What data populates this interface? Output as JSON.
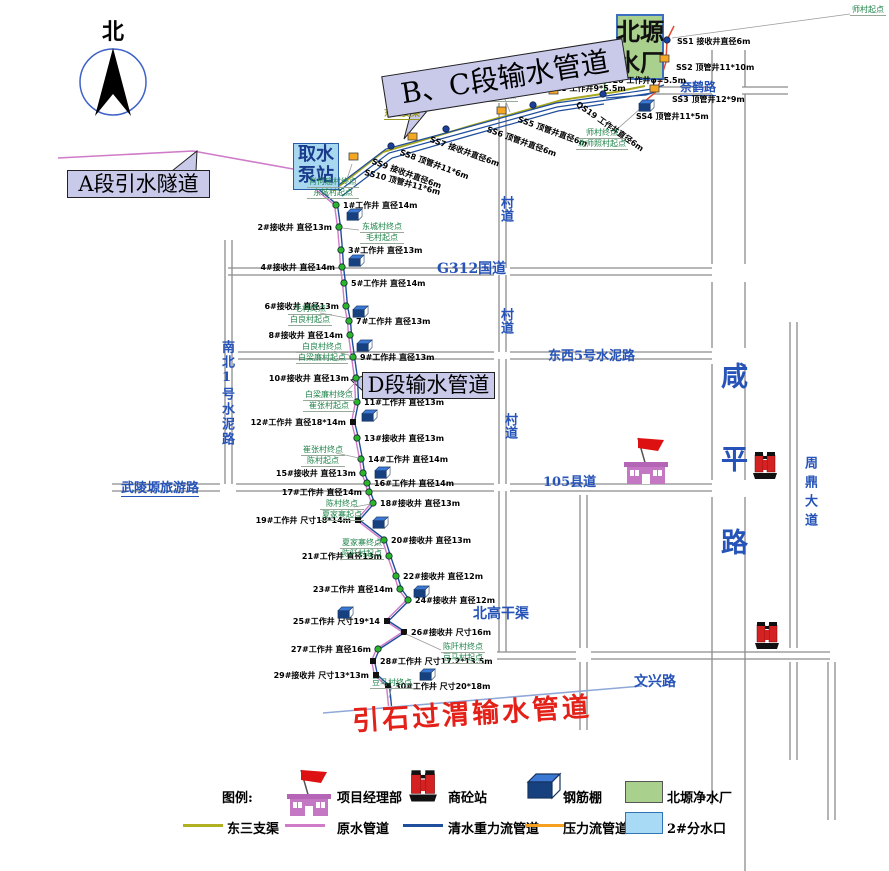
{
  "map": {
    "north_label": "北",
    "section_labels": {
      "bc": "B、C段输水管道",
      "a": "A段引水隧道",
      "d": "D段输水管道"
    },
    "intake_lines": [
      "取水",
      "泵站"
    ],
    "plant_lines": [
      "北塬",
      "净水厂"
    ],
    "yinshi_pipeline": "引石过渭输水管道",
    "dongsan_canal": "东三支渠",
    "road_labels": [
      {
        "text": "G312国道",
        "x": 437,
        "y": 258,
        "size": 14
      },
      {
        "text": "村道",
        "x": 496,
        "y": 196,
        "size": 13,
        "vertical": true
      },
      {
        "text": "村道",
        "x": 496,
        "y": 308,
        "size": 13,
        "vertical": true
      },
      {
        "text": "村道",
        "x": 500,
        "y": 413,
        "size": 13,
        "vertical": true
      },
      {
        "text": "东西5号水泥路",
        "x": 548,
        "y": 345,
        "size": 13
      },
      {
        "text": "105县道",
        "x": 543,
        "y": 471,
        "size": 13
      },
      {
        "text": "武陵塬旅游路",
        "x": 121,
        "y": 477,
        "size": 13,
        "underline": true
      },
      {
        "text": "南北1号水泥路",
        "x": 217,
        "y": 340,
        "size": 13,
        "vertical": true,
        "spacing": 2
      },
      {
        "text": "咸平路",
        "x": 712,
        "y": 362,
        "size": 27,
        "vertical": true,
        "spacing": 56
      },
      {
        "text": "周鼎大道",
        "x": 800,
        "y": 456,
        "size": 13,
        "vertical": true,
        "spacing": 6
      },
      {
        "text": "文兴路",
        "x": 634,
        "y": 671,
        "size": 14
      },
      {
        "text": "北高干渠",
        "x": 473,
        "y": 603,
        "size": 14
      },
      {
        "text": "奈鹤路",
        "x": 680,
        "y": 78,
        "size": 12,
        "underline": true
      }
    ],
    "wells": [
      {
        "t": "1#工作井 直径14m",
        "x": 336,
        "y": 205,
        "s": "r",
        "k": "dot"
      },
      {
        "t": "2#接收井 直径13m",
        "x": 339,
        "y": 227,
        "s": "l",
        "k": "dot"
      },
      {
        "t": "3#工作井 直径13m",
        "x": 341,
        "y": 250,
        "s": "r",
        "k": "dot"
      },
      {
        "t": "4#接收井 直径14m",
        "x": 342,
        "y": 267,
        "s": "l",
        "k": "dot"
      },
      {
        "t": "5#工作井 直径14m",
        "x": 344,
        "y": 283,
        "s": "r",
        "k": "dot"
      },
      {
        "t": "6#接收井 直径13m",
        "x": 346,
        "y": 306,
        "s": "l",
        "k": "dot"
      },
      {
        "t": "7#工作井 直径13m",
        "x": 349,
        "y": 321,
        "s": "r",
        "k": "dot"
      },
      {
        "t": "8#接收井 直径14m",
        "x": 350,
        "y": 335,
        "s": "l",
        "k": "dot"
      },
      {
        "t": "9#工作井 直径13m",
        "x": 353,
        "y": 357,
        "s": "r",
        "k": "dot"
      },
      {
        "t": "10#接收井 直径13m",
        "x": 356,
        "y": 378,
        "s": "l",
        "k": "dot"
      },
      {
        "t": "11#工作井 直径13m",
        "x": 357,
        "y": 402,
        "s": "r",
        "k": "dot"
      },
      {
        "t": "12#工作井 直径18*14m",
        "x": 353,
        "y": 422,
        "s": "l",
        "k": "bsq"
      },
      {
        "t": "13#接收井 直径13m",
        "x": 357,
        "y": 438,
        "s": "r",
        "k": "dot"
      },
      {
        "t": "14#工作井 直径14m",
        "x": 361,
        "y": 459,
        "s": "r",
        "k": "dot"
      },
      {
        "t": "15#接收井 直径13m",
        "x": 363,
        "y": 473,
        "s": "l",
        "k": "dot"
      },
      {
        "t": "16#工作井 直径14m",
        "x": 367,
        "y": 483,
        "s": "r",
        "k": "dot"
      },
      {
        "t": "17#工作井 直径14m",
        "x": 369,
        "y": 492,
        "s": "l",
        "k": "dot"
      },
      {
        "t": "18#接收井 直径13m",
        "x": 373,
        "y": 503,
        "s": "r",
        "k": "dot"
      },
      {
        "t": "19#工作井 尺寸18*14m",
        "x": 358,
        "y": 520,
        "s": "l",
        "k": "bsq"
      },
      {
        "t": "20#接收井 直径13m",
        "x": 384,
        "y": 540,
        "s": "r",
        "k": "dot"
      },
      {
        "t": "21#工作井 直径13m",
        "x": 389,
        "y": 556,
        "s": "l",
        "k": "dot"
      },
      {
        "t": "22#接收井 直径12m",
        "x": 396,
        "y": 576,
        "s": "r",
        "k": "dot"
      },
      {
        "t": "23#工作井 直径14m",
        "x": 400,
        "y": 589,
        "s": "l",
        "k": "dot"
      },
      {
        "t": "24#接收井 直径12m",
        "x": 408,
        "y": 600,
        "s": "r",
        "k": "dot"
      },
      {
        "t": "25#工作井 尺寸19*14",
        "x": 387,
        "y": 621,
        "s": "l",
        "k": "bsq"
      },
      {
        "t": "26#接收井 尺寸16m",
        "x": 404,
        "y": 632,
        "s": "r",
        "k": "bsq"
      },
      {
        "t": "27#工作井 直径16m",
        "x": 378,
        "y": 649,
        "s": "l",
        "k": "dot"
      },
      {
        "t": "28#工作井 尺寸17.2*13.5m",
        "x": 373,
        "y": 661,
        "s": "r",
        "k": "bsq"
      },
      {
        "t": "29#接收井 尺寸13*13m",
        "x": 376,
        "y": 675,
        "s": "l",
        "k": "bsq"
      },
      {
        "t": "30#工作井 尺寸20*18m",
        "x": 388,
        "y": 686,
        "s": "r",
        "k": "bsq"
      }
    ],
    "ss_wells": [
      {
        "t": "SS1 接收井直径6m",
        "x": 677,
        "y": 36,
        "rot": 0,
        "k": "dot",
        "nx": 667,
        "ny": 40
      },
      {
        "t": "SS2 顶管井11*10m",
        "x": 676,
        "y": 62,
        "rot": 0,
        "k": "sq",
        "nx": 664,
        "ny": 58
      },
      {
        "t": "SS3 顶管井12*9m",
        "x": 672,
        "y": 94,
        "rot": 0,
        "k": "sq",
        "nx": 654,
        "ny": 88
      },
      {
        "t": "SS4 顶管井11*5m",
        "x": 636,
        "y": 111,
        "rot": 0,
        "k": "none",
        "nx": 641,
        "ny": 100
      },
      {
        "t": "QS20 工作井φ=5.5m",
        "x": 600,
        "y": 75,
        "rot": 0,
        "k": "sq",
        "nx": 600,
        "ny": 66
      },
      {
        "t": "QS19 工作井直径6m",
        "x": 580,
        "y": 99,
        "rot": 35,
        "k": "dot",
        "nx": 603,
        "ny": 94
      },
      {
        "t": "QS18 工作井9*5.5m",
        "x": 543,
        "y": 83,
        "rot": 0,
        "k": "sq",
        "nx": 553,
        "ny": 90
      },
      {
        "t": "SS5 顶管井直径6m",
        "x": 520,
        "y": 114,
        "rot": 20,
        "k": "dot",
        "nx": 533,
        "ny": 105
      },
      {
        "t": "SS6 顶管井直径6m",
        "x": 489,
        "y": 124,
        "rot": 20,
        "k": "sq",
        "nx": 501,
        "ny": 110
      },
      {
        "t": "SS7 接收井直径6m",
        "x": 432,
        "y": 134,
        "rot": 20,
        "k": "dot",
        "nx": 446,
        "ny": 129
      },
      {
        "t": "SS8 顶管井11*6m",
        "x": 402,
        "y": 147,
        "rot": 20,
        "k": "sq",
        "nx": 412,
        "ny": 136
      },
      {
        "t": "SS9 接收井直径6m",
        "x": 374,
        "y": 156,
        "rot": 20,
        "k": "dot",
        "nx": 391,
        "ny": 146
      },
      {
        "t": "SS10 顶管井11*6m",
        "x": 366,
        "y": 167,
        "rot": 15,
        "k": "sq",
        "nx": 353,
        "ny": 156
      }
    ],
    "callouts": [
      {
        "lines": [
          "师村起点"
        ],
        "x": 850,
        "y": 5,
        "a": [
          850,
          14
        ],
        "t": [
          672,
          38
        ]
      },
      {
        "lines": [
          "北寺照村终点",
          "肖何庙村起点"
        ],
        "x": 466,
        "y": 80,
        "a": [
          504,
          97
        ],
        "t": [
          510,
          112
        ]
      },
      {
        "lines": [
          "师村终点",
          "北师照村起点"
        ],
        "x": 576,
        "y": 128,
        "a": [
          614,
          132
        ],
        "t": [
          650,
          100
        ]
      },
      {
        "lines": [
          "肖何庙村终点",
          "东城村起点"
        ],
        "x": 307,
        "y": 177,
        "a": [
          346,
          182
        ],
        "t": [
          352,
          164
        ]
      },
      {
        "lines": [
          "东城村终点",
          "毛村起点"
        ],
        "x": 360,
        "y": 222,
        "a": [
          359,
          230
        ],
        "t": [
          342,
          228
        ]
      },
      {
        "lines": [
          "毛村终点",
          "白良村起点"
        ],
        "x": 288,
        "y": 304,
        "a": [
          320,
          313
        ],
        "t": [
          347,
          318
        ]
      },
      {
        "lines": [
          "白良村终点",
          "白梁廉村起点"
        ],
        "x": 296,
        "y": 342,
        "a": [
          334,
          351
        ],
        "t": [
          352,
          356
        ]
      },
      {
        "lines": [
          "白梁廉村终点",
          "崔张村起点"
        ],
        "x": 303,
        "y": 390,
        "a": [
          341,
          397
        ],
        "t": [
          356,
          382
        ]
      },
      {
        "lines": [
          "崔张村终点",
          "陈村起点"
        ],
        "x": 301,
        "y": 445,
        "a": [
          336,
          453
        ],
        "t": [
          359,
          458
        ]
      },
      {
        "lines": [
          "陈村终点",
          "夏家寨起点"
        ],
        "x": 320,
        "y": 499,
        "a": [
          354,
          507
        ],
        "t": [
          371,
          504
        ]
      },
      {
        "lines": [
          "夏家寨终点",
          "陈阡村起点"
        ],
        "x": 340,
        "y": 538,
        "a": [
          374,
          546
        ],
        "t": [
          382,
          541
        ]
      },
      {
        "lines": [
          "陈阡村终点",
          "豆马村起点"
        ],
        "x": 441,
        "y": 642,
        "a": [
          441,
          650
        ],
        "t": [
          406,
          634
        ]
      },
      {
        "lines": [
          "豆马村终点"
        ],
        "x": 370,
        "y": 678,
        "a": [
          392,
          686
        ],
        "t": [
          389,
          698
        ]
      }
    ],
    "sheds": [
      [
        346,
        206
      ],
      [
        348,
        252
      ],
      [
        352,
        303
      ],
      [
        356,
        337
      ],
      [
        361,
        407
      ],
      [
        374,
        464
      ],
      [
        372,
        514
      ],
      [
        413,
        583
      ],
      [
        337,
        604
      ],
      [
        419,
        666
      ],
      [
        638,
        97
      ]
    ],
    "machines": [
      [
        752,
        450
      ],
      [
        754,
        620
      ]
    ],
    "hq_buildings": [
      [
        624,
        436
      ]
    ]
  },
  "legend": {
    "caption": "图例:",
    "row1": [
      {
        "icon": "hq-icon",
        "label": "项目经理部",
        "ix": 287,
        "lx": 337
      },
      {
        "icon": "batch-plant-icon",
        "label": "商砼站",
        "ix": 408,
        "lx": 448
      },
      {
        "icon": "rebar-shed-icon",
        "label": "钢筋棚",
        "ix": 526,
        "lx": 563
      },
      {
        "icon": "green-rect",
        "label": "北塬净水厂",
        "ix": 625,
        "lx": 667
      }
    ],
    "row2": [
      {
        "icon": "line-olive",
        "label": "东三支渠",
        "ix": 183,
        "lx": 227
      },
      {
        "icon": "line-pink",
        "label": "原水管道",
        "ix": 285,
        "lx": 337
      },
      {
        "icon": "line-blue",
        "label": "清水重力流管道",
        "ix": 403,
        "lx": 448
      },
      {
        "icon": "line-orange",
        "label": "压力流管道",
        "ix": 525,
        "lx": 563
      },
      {
        "icon": "cyan-rect",
        "label": "2#分水口",
        "ix": 625,
        "lx": 667
      }
    ]
  },
  "colors": {
    "road_label": "#2553b8",
    "pipeline_blue": "#1f4e9c",
    "raw_water_pink": "#cf7bc8",
    "canal_olive": "#a8a820",
    "pressure_line_red": "#e14b32",
    "legend_orange": "#f5a11f",
    "green_connector": "#3faf3f",
    "plant_green": "#a9d08d",
    "intake_cyan": "#a8d8f0",
    "label_lavender": "#c9c9ea",
    "yinshi_line_blue": "#8fa8d8",
    "red_title": "#e32118",
    "callout_green": "#1d8348"
  }
}
